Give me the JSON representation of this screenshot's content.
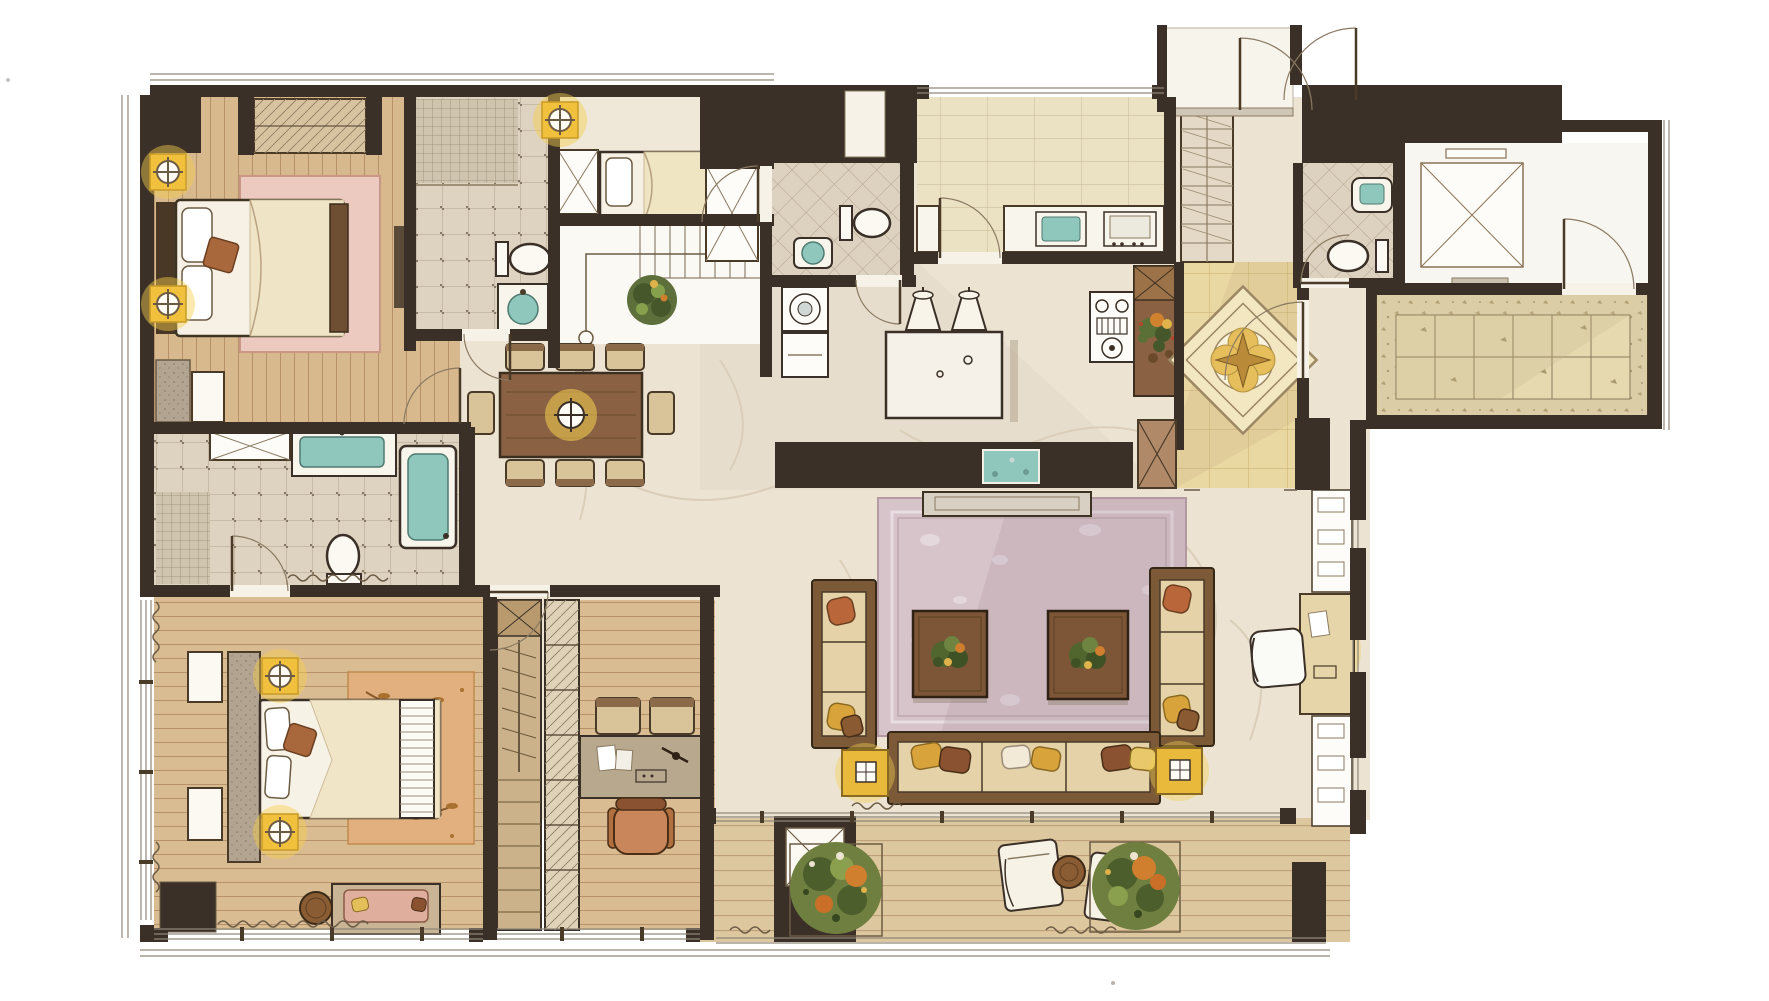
{
  "figure": {
    "type": "floor-plan",
    "style": "hand-drawn watercolor interior rendering",
    "view": "top-down"
  },
  "labels": {
    "stairs_up": "上"
  },
  "palette": {
    "walls": "#3a3027",
    "wood_floor": "#d8b98e",
    "marble_floor": "#ece3d2",
    "kitchen_tile": "#ebe2c4",
    "foyer_tile": "#ead8a2",
    "granite_balcony": "#dbcda6",
    "accent_yellow": "#f1c13d",
    "water_teal": "#8fc7bd",
    "bedroom_rug_pink": "#eccabf",
    "living_rug_mauve": "#d7c3ca",
    "sofa_wood": "#7c5a38",
    "cushion": "#e5d2a8",
    "plant_green": "#5d6f3a",
    "plant_orange": "#cf7f2e"
  },
  "rooms": [
    {
      "id": "bedroom-2",
      "floor": "wood-plank",
      "contents": [
        "double-bed",
        "pillows",
        "wardrobe",
        "pink-floral-rug",
        "wall-lamps",
        "bench",
        "mirror"
      ]
    },
    {
      "id": "bathroom-2",
      "floor": "ceramic-tile",
      "contents": [
        "mosaic-shower",
        "toilet",
        "vanity-sink"
      ]
    },
    {
      "id": "staff-room",
      "floor": "stone",
      "contents": [
        "single-bed",
        "cabinet",
        "wardrobe",
        "ceiling-lamp"
      ]
    },
    {
      "id": "staircase",
      "contents": [
        "steps",
        "up-arrow",
        "handrail-post",
        "potted-plant"
      ]
    },
    {
      "id": "dining-area",
      "floor": "marble",
      "contents": [
        "dining-table",
        "eight-chairs",
        "pendant-light"
      ]
    },
    {
      "id": "powder-room",
      "floor": "tile",
      "contents": [
        "toilet",
        "sink"
      ]
    },
    {
      "id": "laundry",
      "contents": [
        "washing-machine",
        "cabinet"
      ]
    },
    {
      "id": "kitchen",
      "floor": "stone-tile",
      "contents": [
        "counter",
        "sink",
        "appliance",
        "island",
        "two-kettles",
        "gas-stove",
        "plant-console"
      ]
    },
    {
      "id": "foyer",
      "floor": "inlaid-marble-medallion",
      "contents": [
        "shoe-cabinet",
        "decorative-medallion"
      ]
    },
    {
      "id": "entry-vestibule",
      "contents": [
        "double-entry-doors",
        "threshold"
      ]
    },
    {
      "id": "guest-bathroom",
      "floor": "diagonal-tile",
      "contents": [
        "toilet",
        "sink"
      ]
    },
    {
      "id": "elevator-lobby",
      "contents": [
        "elevator-cab",
        "call-panel",
        "vent-shaft"
      ]
    },
    {
      "id": "service-balcony",
      "floor": "granite-tile",
      "contents": []
    },
    {
      "id": "living-room",
      "floor": "marble",
      "contents": [
        "left-sofa",
        "right-sofa",
        "long-sofa",
        "throw-pillows",
        "two-coffee-tables-with-plants",
        "two-lamp-side-tables",
        "tv-console",
        "aquarium",
        "area-rug"
      ]
    },
    {
      "id": "reading-nook",
      "contents": [
        "desk",
        "white-chair",
        "shelving-units"
      ]
    },
    {
      "id": "master-bathroom",
      "floor": "ceramic-tile",
      "contents": [
        "mosaic-shower",
        "vanity-sink",
        "toilet",
        "bathtub",
        "cabinet"
      ]
    },
    {
      "id": "master-bedroom",
      "floor": "wood-plank",
      "contents": [
        "king-bed",
        "headboard-wall",
        "nightstand-lamps",
        "leaf-pattern-rug",
        "window-benches",
        "loveseat",
        "round-side-table",
        "dark-cabinet",
        "wardrobe"
      ]
    },
    {
      "id": "study",
      "floor": "wood-plank",
      "contents": [
        "desk",
        "office-chair",
        "two-guest-chairs",
        "bookcase",
        "closet"
      ]
    },
    {
      "id": "terrace",
      "floor": "wood-deck",
      "contents": [
        "two-lounge-chairs",
        "round-table",
        "two-planter-shrubs",
        "structural-column"
      ]
    }
  ]
}
